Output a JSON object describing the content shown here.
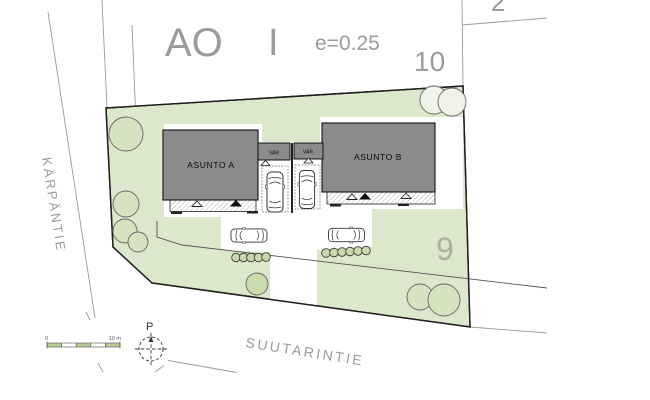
{
  "title_block": {
    "zoning_code": "AO",
    "storeys": "I",
    "efficiency": "e=0.25"
  },
  "lots": {
    "top": "10",
    "top_right": "2",
    "right": "9"
  },
  "streets": {
    "left": "KÄRPÄNTIE",
    "bottom": "SUUTARINTIE"
  },
  "buildings": {
    "a": {
      "label": "ASUNTO A",
      "storage_label": "VAR"
    },
    "b": {
      "label": "ASUNTO B",
      "storage_label": "VAR"
    }
  },
  "north": {
    "label": "P"
  },
  "scalebar": {
    "zero": "0",
    "ten": "10 m"
  },
  "colors": {
    "plot_green": "#dce8cc",
    "tree_green": "#d5e3c1",
    "bush_green": "#c9d9ab",
    "building_gray": "#8b8b8b",
    "line_gray": "#999999",
    "label_gray": "#9b9b9b",
    "scalebar_green": "#b7cd92"
  }
}
